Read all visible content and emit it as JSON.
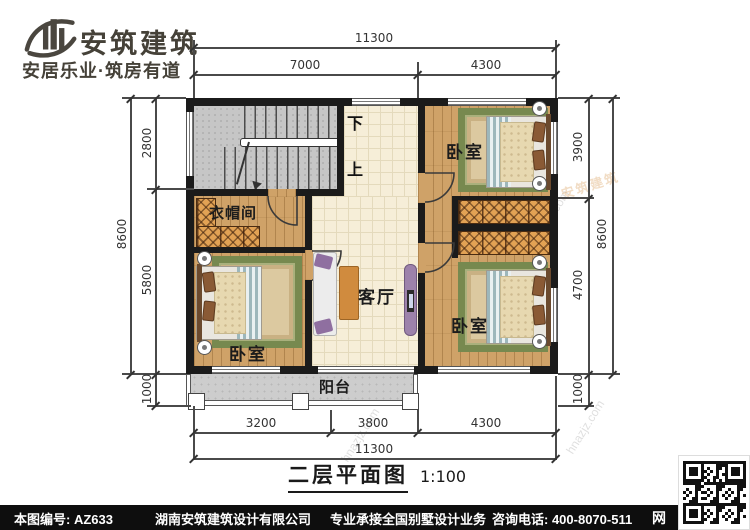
{
  "header": {
    "brand": "安筑建筑",
    "tagline": "安居乐业·筑房有道"
  },
  "plan": {
    "rooms": {
      "bedroom": "卧室",
      "cloakroom": "衣帽间",
      "living_room": "客厅",
      "balcony": "阳台",
      "stairs_down": "下",
      "stairs_up": "上"
    },
    "dimensions": {
      "top": {
        "total": "11300",
        "segments": [
          "7000",
          "4300"
        ]
      },
      "bottom": {
        "total": "11300",
        "segments": [
          "3200",
          "3800",
          "4300"
        ]
      },
      "left": {
        "total": "8600",
        "segments": [
          "2800",
          "5800",
          "1000"
        ]
      },
      "right": {
        "total": "8600",
        "segments": [
          "3900",
          "4700",
          "1000"
        ]
      }
    }
  },
  "title": {
    "name": "二层平面图",
    "scale": "1:100"
  },
  "footer": {
    "drawing_no": "本图编号: AZ633",
    "company": "湖南安筑建筑设计有限公司",
    "service": "专业承接全国别墅设计业务",
    "phone": "咨询电话: 400-8070-511",
    "web": "网"
  },
  "watermark": {
    "site": "hnazjz.com",
    "brand": "安筑建筑"
  },
  "colors": {
    "wall": "#1b1b1b",
    "wood": "#cfa268",
    "tile": "#f6eed8",
    "concrete": "#c6c6c6",
    "rug_border": "#77894f",
    "wardrobe": "#e2a254",
    "footer_bg": "#0e0e0e"
  }
}
